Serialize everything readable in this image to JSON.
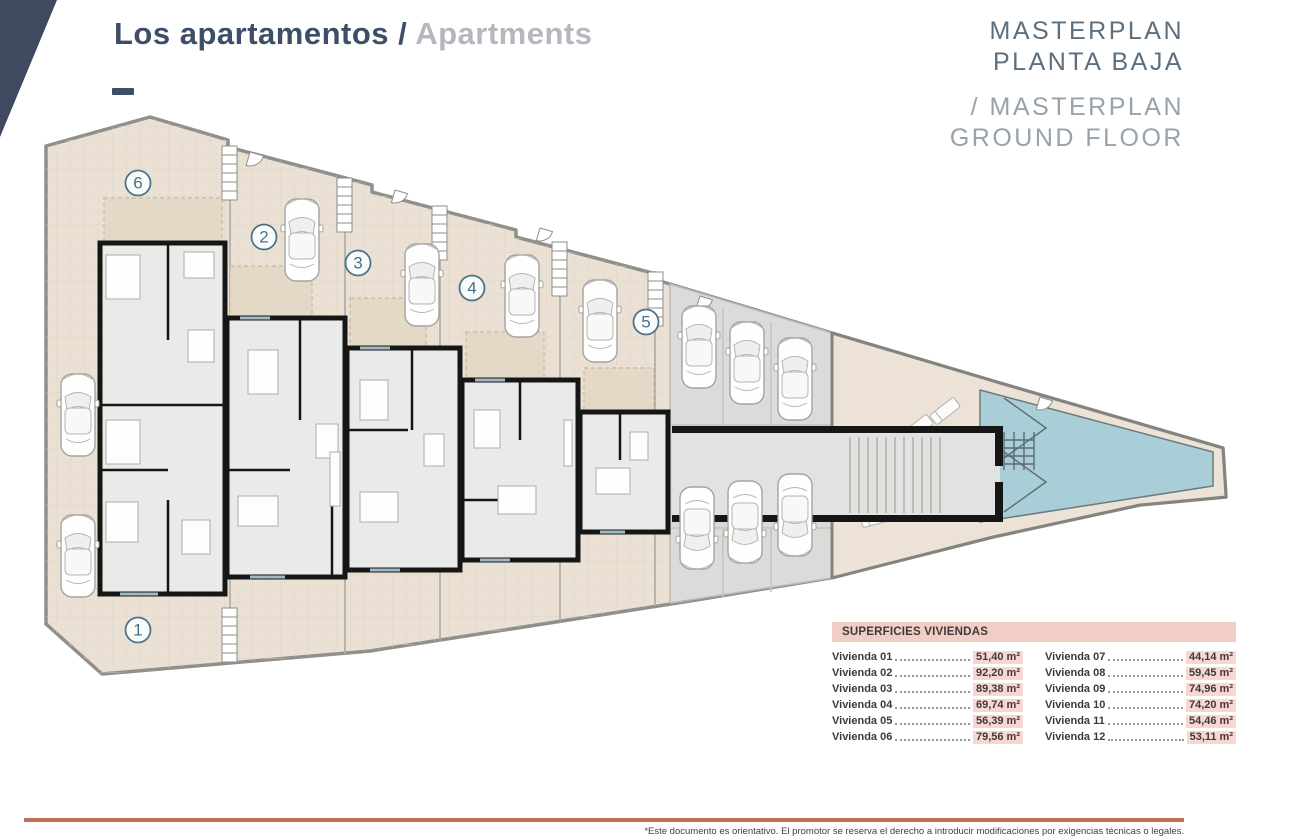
{
  "header": {
    "title": {
      "primary": "Los apartamentos",
      "separator": " / ",
      "secondary": "Apartments"
    },
    "masterplan": {
      "es_line1": "MASTERPLAN",
      "es_line2": "PLANTA BAJA",
      "en_line1": "/ MASTERPLAN",
      "en_line2": "GROUND FLOOR"
    }
  },
  "plan": {
    "unit_labels": [
      "6",
      "2",
      "3",
      "4",
      "5",
      "1"
    ]
  },
  "surfaces_table": {
    "title": "SUPERFICIES VIVIENDAS",
    "col1": [
      {
        "label": "Vivienda 01",
        "value": "51,40 m²"
      },
      {
        "label": "Vivienda 02",
        "value": "92,20 m²"
      },
      {
        "label": "Vivienda 03",
        "value": "89,38 m²"
      },
      {
        "label": "Vivienda 04",
        "value": "69,74 m²"
      },
      {
        "label": "Vivienda 05",
        "value": "56,39 m²"
      },
      {
        "label": "Vivienda 06",
        "value": "79,56 m²"
      }
    ],
    "col2": [
      {
        "label": "Vivienda 07",
        "value": "44,14 m²"
      },
      {
        "label": "Vivienda 08",
        "value": "59,45 m²"
      },
      {
        "label": "Vivienda 09",
        "value": "74,96 m²"
      },
      {
        "label": "Vivienda 10",
        "value": "74,20 m²"
      },
      {
        "label": "Vivienda 11",
        "value": "54,46 m²"
      },
      {
        "label": "Vivienda 12",
        "value": "53,11 m²"
      }
    ]
  },
  "footer": {
    "disclaimer": "*Este documento es orientativo. El promotor se reserva el derecho a introducir modificaciones por exigencias técnicas o legales."
  },
  "colors": {
    "navy": "#3d4e66",
    "masterplan_gray": "#5d6f7e",
    "accent_line": "#c06e54",
    "table_pink": "#f2cdc5",
    "pool_blue": "#a9ced8",
    "terrace_beige": "#eae1d4"
  }
}
